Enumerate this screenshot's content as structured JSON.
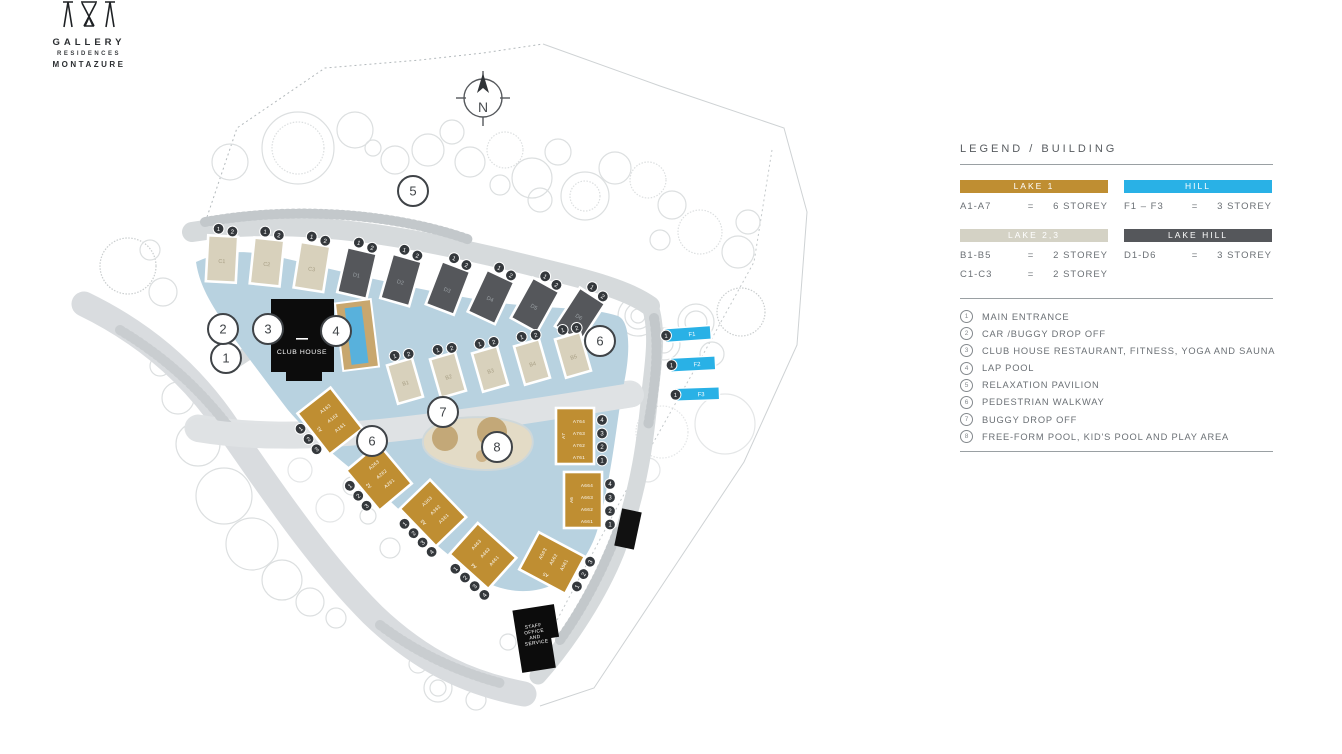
{
  "brand": {
    "line1": "GALLERY",
    "line2": "RESIDENCES",
    "line3": "MONTAZURE"
  },
  "compass": {
    "label": "N"
  },
  "colors": {
    "gold": "#bf8e32",
    "cyan": "#29b1e6",
    "beige": "#d8d1bc",
    "dark": "#55575b",
    "lake": "#b8d2e0",
    "road": "#d6dadc",
    "pool": "#58b1dc",
    "deck": "#c8a76e",
    "black": "#0c0c0c"
  },
  "legend": {
    "title": "LEGEND / BUILDING",
    "groups": [
      {
        "name": "LAKE 1",
        "color": "#bf8e32",
        "rows": [
          {
            "range": "A1-A7",
            "eq": "=",
            "storey": "6 STOREY"
          }
        ]
      },
      {
        "name": "HILL",
        "color": "#29b1e6",
        "rows": [
          {
            "range": "F1 – F3",
            "eq": "=",
            "storey": "3 STOREY"
          }
        ]
      },
      {
        "name": "LAKE 2,3",
        "color": "#d4d2c5",
        "rows": [
          {
            "range": "B1-B5",
            "eq": "=",
            "storey": "2 STOREY"
          },
          {
            "range": "C1-C3",
            "eq": "=",
            "storey": "2 STOREY"
          }
        ]
      },
      {
        "name": "LAKE HILL",
        "color": "#55575b",
        "rows": [
          {
            "range": "D1-D6",
            "eq": "=",
            "storey": "3 STOREY"
          }
        ]
      }
    ],
    "poi": [
      {
        "num": "1",
        "label": "MAIN ENTRANCE"
      },
      {
        "num": "2",
        "label": "CAR /BUGGY DROP OFF"
      },
      {
        "num": "3",
        "label": "CLUB HOUSE RESTAURANT, FITNESS, YOGA AND SAUNA"
      },
      {
        "num": "4",
        "label": "LAP POOL"
      },
      {
        "num": "5",
        "label": "RELAXATION PAVILION"
      },
      {
        "num": "6",
        "label": "PEDESTRIAN WALKWAY"
      },
      {
        "num": "7",
        "label": "BUGGY DROP OFF"
      },
      {
        "num": "8",
        "label": "FREE-FORM POOL, KID'S POOL AND PLAY AREA"
      }
    ]
  },
  "map": {
    "club_house_label": "CLUB HOUSE",
    "staff_office_lines": [
      "STAFF",
      "OFFICE",
      "AND",
      "SERVICE"
    ],
    "buildings": [
      {
        "id": "C1",
        "type": "slab",
        "fill": "beige",
        "x": 222,
        "y": 259,
        "w": 30,
        "h": 46,
        "rot": 3,
        "label": "C1",
        "badges": [
          "1",
          "2"
        ],
        "edge": "top"
      },
      {
        "id": "C2",
        "type": "slab",
        "fill": "beige",
        "x": 267,
        "y": 262,
        "w": 30,
        "h": 46,
        "rot": 6,
        "label": "C2",
        "badges": [
          "1",
          "2"
        ],
        "edge": "top"
      },
      {
        "id": "C3",
        "type": "slab",
        "fill": "beige",
        "x": 312,
        "y": 267,
        "w": 30,
        "h": 46,
        "rot": 9,
        "label": "C3",
        "badges": [
          "1",
          "2"
        ],
        "edge": "top"
      },
      {
        "id": "D1",
        "type": "slab",
        "fill": "dark",
        "x": 357,
        "y": 273,
        "w": 30,
        "h": 46,
        "rot": 13,
        "label": "D1",
        "badges": [
          "1",
          "2"
        ],
        "edge": "top"
      },
      {
        "id": "D2",
        "type": "slab",
        "fill": "dark",
        "x": 401,
        "y": 280,
        "w": 30,
        "h": 46,
        "rot": 16,
        "label": "D2",
        "badges": [
          "1",
          "2"
        ],
        "edge": "top"
      },
      {
        "id": "D3",
        "type": "slab",
        "fill": "dark",
        "x": 448,
        "y": 288,
        "w": 30,
        "h": 46,
        "rot": 21,
        "label": "D3",
        "badges": [
          "1",
          "2"
        ],
        "edge": "top"
      },
      {
        "id": "D4",
        "type": "slab",
        "fill": "dark",
        "x": 491,
        "y": 297,
        "w": 30,
        "h": 46,
        "rot": 25,
        "label": "D4",
        "badges": [
          "1",
          "2"
        ],
        "edge": "top"
      },
      {
        "id": "D5",
        "type": "slab",
        "fill": "dark",
        "x": 535,
        "y": 305,
        "w": 30,
        "h": 46,
        "rot": 29,
        "label": "D5",
        "badges": [
          "1",
          "2"
        ],
        "edge": "top"
      },
      {
        "id": "D6",
        "type": "slab",
        "fill": "dark",
        "x": 580,
        "y": 315,
        "w": 30,
        "h": 46,
        "rot": 33,
        "label": "D6",
        "badges": [
          "1",
          "2"
        ],
        "edge": "top"
      },
      {
        "id": "B1",
        "type": "slab",
        "fill": "beige",
        "x": 405,
        "y": 381,
        "w": 26,
        "h": 40,
        "rot": -16,
        "label": "B1",
        "badges": [
          "1",
          "2"
        ],
        "edge": "top"
      },
      {
        "id": "B2",
        "type": "slab",
        "fill": "beige",
        "x": 448,
        "y": 375,
        "w": 26,
        "h": 40,
        "rot": -16,
        "label": "B2",
        "badges": [
          "1",
          "2"
        ],
        "edge": "top"
      },
      {
        "id": "B3",
        "type": "slab",
        "fill": "beige",
        "x": 490,
        "y": 369,
        "w": 26,
        "h": 40,
        "rot": -16,
        "label": "B3",
        "badges": [
          "1",
          "2"
        ],
        "edge": "top"
      },
      {
        "id": "B4",
        "type": "slab",
        "fill": "beige",
        "x": 532,
        "y": 362,
        "w": 26,
        "h": 40,
        "rot": -16,
        "label": "B4",
        "badges": [
          "1",
          "2"
        ],
        "edge": "top"
      },
      {
        "id": "B5",
        "type": "slab",
        "fill": "beige",
        "x": 573,
        "y": 355,
        "w": 26,
        "h": 40,
        "rot": -16,
        "label": "B5",
        "badges": [
          "1",
          "2"
        ],
        "edge": "top"
      },
      {
        "id": "A1",
        "type": "gold",
        "fill": "gold",
        "x": 330,
        "y": 421,
        "w": 42,
        "h": 52,
        "rot": -38,
        "label": "A1",
        "units": [
          "A163",
          "A162",
          "A161"
        ],
        "badges": [
          "1",
          "2",
          "3"
        ],
        "edge": "left"
      },
      {
        "id": "A2",
        "type": "gold",
        "fill": "gold",
        "x": 379,
        "y": 477,
        "w": 42,
        "h": 52,
        "rot": -40,
        "label": "A2",
        "units": [
          "A263",
          "A262",
          "A261"
        ],
        "badges": [
          "1",
          "2",
          "3"
        ],
        "edge": "left"
      },
      {
        "id": "A3",
        "type": "gold",
        "fill": "gold",
        "x": 433,
        "y": 513,
        "w": 42,
        "h": 52,
        "rot": -44,
        "label": "A3",
        "units": [
          "A363",
          "A362",
          "A361"
        ],
        "badges": [
          "1",
          "2",
          "3",
          "4"
        ],
        "edge": "left"
      },
      {
        "id": "A4",
        "type": "gold",
        "fill": "gold",
        "x": 483,
        "y": 556,
        "w": 42,
        "h": 52,
        "rot": -48,
        "label": "A4",
        "units": [
          "A463",
          "A462",
          "A461"
        ],
        "badges": [
          "1",
          "2",
          "3",
          "4"
        ],
        "edge": "left"
      },
      {
        "id": "A5",
        "type": "gold",
        "fill": "gold",
        "x": 552,
        "y": 563,
        "w": 42,
        "h": 52,
        "rot": -62,
        "label": "A5",
        "units": [
          "A563",
          "A562",
          "A561"
        ],
        "badges": [
          "1",
          "2",
          "3"
        ],
        "edge": "bottom"
      },
      {
        "id": "A6",
        "type": "gold",
        "fill": "gold",
        "x": 583,
        "y": 500,
        "w": 38,
        "h": 56,
        "rot": 0,
        "label": "A6",
        "units": [
          "A664",
          "A663",
          "A662",
          "A661"
        ],
        "badges": [
          "4",
          "3",
          "2",
          "1"
        ],
        "edge": "right"
      },
      {
        "id": "A7",
        "type": "gold",
        "fill": "gold",
        "x": 575,
        "y": 436,
        "w": 38,
        "h": 56,
        "rot": 0,
        "label": "A7",
        "units": [
          "A764",
          "A763",
          "A762",
          "A761"
        ],
        "badges": [
          "4",
          "3",
          "2",
          "1"
        ],
        "edge": "right"
      },
      {
        "id": "F1",
        "type": "fbar",
        "fill": "cyan",
        "x": 688,
        "y": 334,
        "w": 46,
        "h": 14,
        "rot": -4,
        "label": "F1",
        "badges": [
          "1"
        ],
        "edge": "leftend"
      },
      {
        "id": "F2",
        "type": "fbar",
        "fill": "cyan",
        "x": 693,
        "y": 364,
        "w": 45,
        "h": 14,
        "rot": -3,
        "label": "F2",
        "badges": [
          "1"
        ],
        "edge": "leftend"
      },
      {
        "id": "F3",
        "type": "fbar",
        "fill": "cyan",
        "x": 697,
        "y": 394,
        "w": 45,
        "h": 13,
        "rot": -2,
        "label": "F3",
        "badges": [
          "1"
        ],
        "edge": "leftend"
      }
    ],
    "markers": [
      {
        "n": "1",
        "x": 226,
        "y": 358
      },
      {
        "n": "2",
        "x": 223,
        "y": 329
      },
      {
        "n": "3",
        "x": 268,
        "y": 329
      },
      {
        "n": "4",
        "x": 336,
        "y": 331
      },
      {
        "n": "5",
        "x": 413,
        "y": 191
      },
      {
        "n": "6",
        "x": 600,
        "y": 341
      },
      {
        "n": "6",
        "x": 372,
        "y": 441
      },
      {
        "n": "7",
        "x": 443,
        "y": 412
      },
      {
        "n": "8",
        "x": 497,
        "y": 447
      }
    ]
  }
}
